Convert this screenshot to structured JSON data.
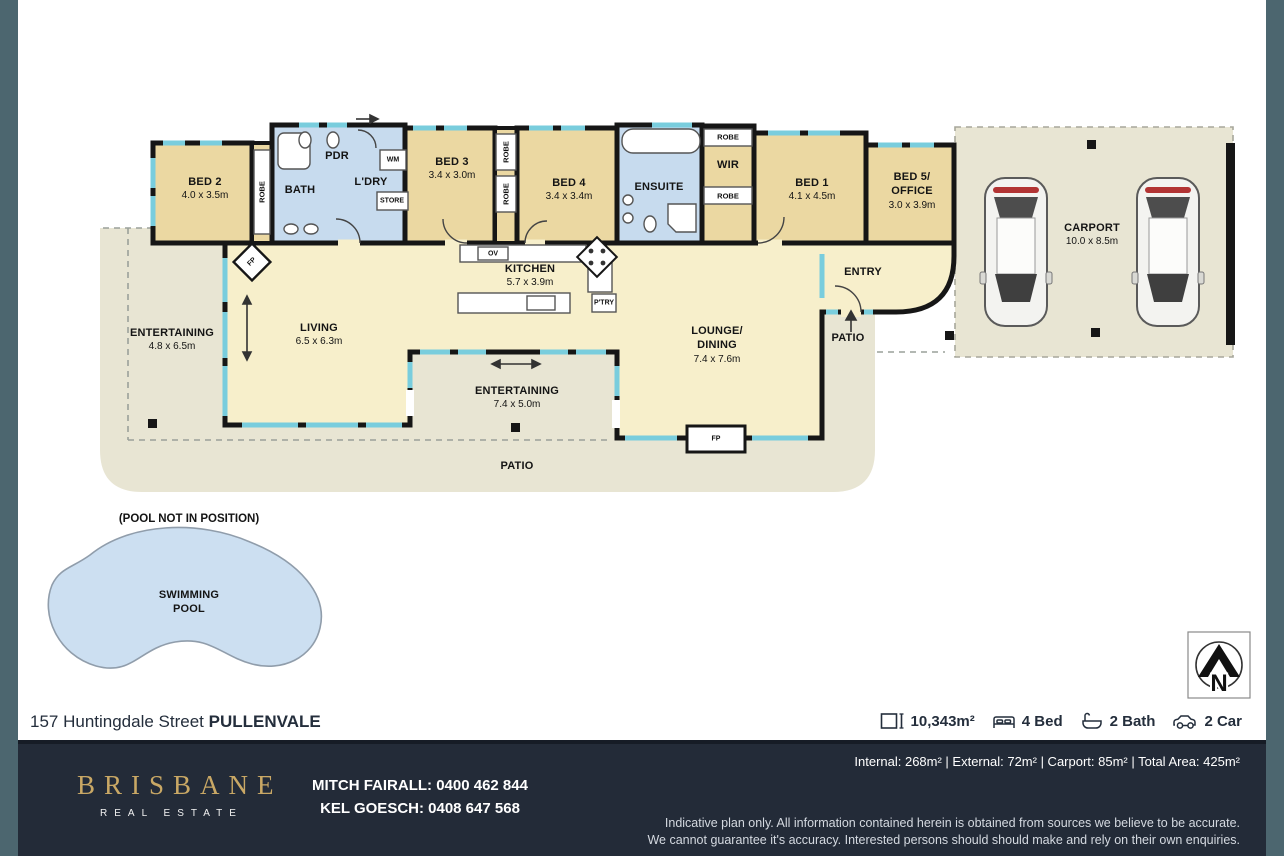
{
  "colors": {
    "edge_slate": "#4c666f",
    "footer_navy": "#232b38",
    "brand_gold": "#c9a865",
    "room_tan": "#ebd8a2",
    "room_pale": "#f7efcb",
    "wet_blue": "#c7dbee",
    "outdoor_beige": "#e8e5d3",
    "window_cyan": "#79cddd",
    "pool_blue": "#ccdff1"
  },
  "plan": {
    "rooms": {
      "bed2": {
        "name": "BED 2",
        "dims": "4.0 x 3.5m"
      },
      "bath": {
        "name": "BATH"
      },
      "pdr": {
        "name": "PDR"
      },
      "ldry": {
        "name": "L'DRY"
      },
      "bed3": {
        "name": "BED 3",
        "dims": "3.4 x 3.0m"
      },
      "bed4": {
        "name": "BED 4",
        "dims": "3.4 x 3.4m"
      },
      "ensuite": {
        "name": "ENSUITE"
      },
      "wir": {
        "name": "WIR"
      },
      "bed1": {
        "name": "BED 1",
        "dims": "4.1 x 4.5m"
      },
      "bed5": {
        "name": "BED 5/",
        "name2": "OFFICE",
        "dims": "3.0 x 3.9m"
      },
      "kitchen": {
        "name": "KITCHEN",
        "dims": "5.7 x 3.9m"
      },
      "living": {
        "name": "LIVING",
        "dims": "6.5 x 6.3m"
      },
      "lounge": {
        "name": "LOUNGE/",
        "name2": "DINING",
        "dims": "7.4 x 7.6m"
      },
      "entertaining_left": {
        "name": "ENTERTAINING",
        "dims": "4.8 x 6.5m"
      },
      "entertaining_mid": {
        "name": "ENTERTAINING",
        "dims": "7.4 x 5.0m"
      },
      "entry": {
        "name": "ENTRY"
      },
      "patio_right": {
        "name": "PATIO"
      },
      "patio_bottom": {
        "name": "PATIO"
      },
      "carport": {
        "name": "CARPORT",
        "dims": "10.0 x 8.5m"
      }
    },
    "fixtures": {
      "robe": "ROBE",
      "ov": "OV",
      "wm": "WM",
      "store": "STORE",
      "ptry": "P'TRY",
      "fp": "FP"
    },
    "pool": {
      "note": "(POOL NOT IN POSITION)",
      "line1": "SWIMMING",
      "line2": "POOL"
    },
    "compass": {
      "letter": "N"
    }
  },
  "address": {
    "street": "157 Huntingdale Street ",
    "suburb": "PULLENVALE"
  },
  "summary": {
    "land": "10,343m²",
    "bed": "4 Bed",
    "bath": "2 Bath",
    "car": "2 Car"
  },
  "footer": {
    "brand": {
      "name": "BRISBANE",
      "tagline": "REAL ESTATE"
    },
    "agents": [
      "MITCH FAIRALL: 0400 462 844",
      "KEL GOESCH: 0408 647 568"
    ],
    "areas_line": "Internal: 268m²  |  External: 72m²  |  Carport: 85m²  |  Total Area: 425m²",
    "disclaimer": [
      "Indicative plan only. All information contained herein is obtained from sources we believe to be accurate.",
      "We cannot guarantee it's accuracy. Interested persons should should make and rely on their own enquiries."
    ]
  }
}
